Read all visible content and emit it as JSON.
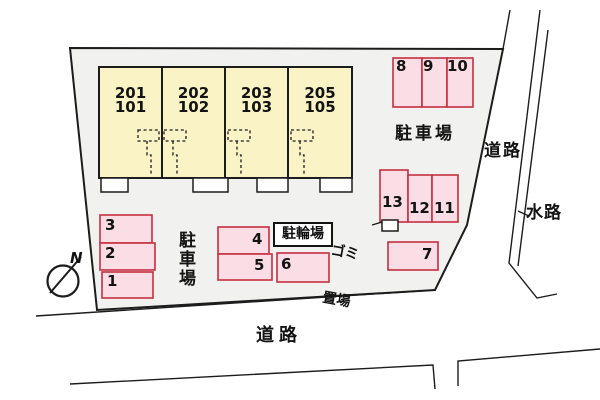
{
  "units": [
    {
      "upper": "201",
      "lower": "101"
    },
    {
      "upper": "202",
      "lower": "102"
    },
    {
      "upper": "203",
      "lower": "103"
    },
    {
      "upper": "205",
      "lower": "105"
    }
  ],
  "spaces": {
    "s1": "1",
    "s2": "2",
    "s3": "3",
    "s4": "4",
    "s5": "5",
    "s6": "6",
    "s7": "7",
    "s8": "8",
    "s9": "9",
    "s10": "10",
    "s11": "11",
    "s12": "12",
    "s13": "13"
  },
  "labels": {
    "parking_upper": "駐車場",
    "parking_lower": "駐車場",
    "bicycle": "駐輪場",
    "garbage_line1": "ゴミ",
    "garbage_line2": "置場",
    "road_right": "道路",
    "road_bottom": "道路",
    "waterway": "水路",
    "compass_north": "N"
  },
  "colors": {
    "parcel_fill": "#f1f1ef",
    "building_fill": "#f9f3c6",
    "space_fill": "#fbdee5",
    "space_stroke": "#c5303f",
    "line": "#1c1c1c"
  }
}
